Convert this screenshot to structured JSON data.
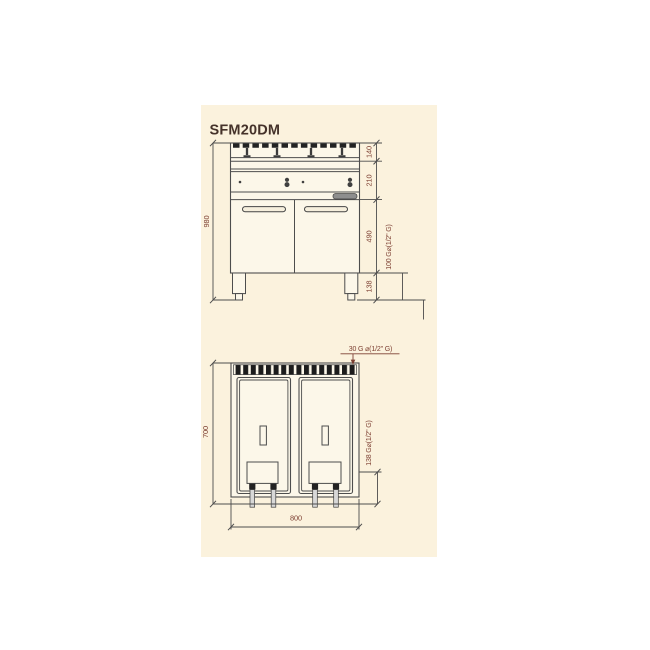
{
  "page": {
    "background": "#ffffff",
    "panel_color": "#fbf2dd"
  },
  "colors": {
    "line": "#4d4d4d",
    "dark_fill": "#242424",
    "dimension_text": "#7d4033",
    "title_text": "#44322a"
  },
  "title": "SFM20DM",
  "front_view": {
    "overall_height": "980",
    "sections": [
      {
        "label": "140"
      },
      {
        "label": "210"
      },
      {
        "label": "490"
      },
      {
        "label": "138"
      }
    ],
    "gas_note": "100 G⌀(1/2\" G)"
  },
  "top_view": {
    "depth": "700",
    "width": "800",
    "gas_top_note": "30 G ⌀(1/2\" G)",
    "gas_rear_note": "138 G⌀(1/2\" G)"
  }
}
